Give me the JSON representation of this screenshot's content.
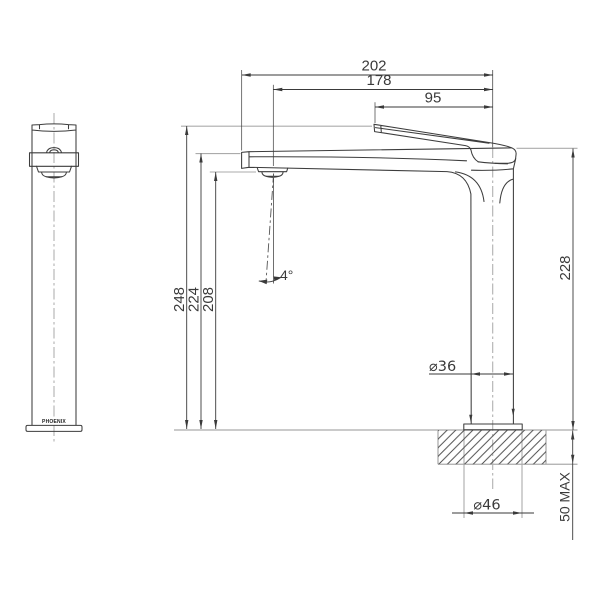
{
  "drawing": {
    "brand_label": "PHOENIX",
    "angle_label": "4°",
    "dimensions": {
      "spout_overall": "202",
      "outlet_to_center": "178",
      "lever_tip_to_center": "95",
      "overall_height": "248",
      "spout_height": "224",
      "outlet_height": "208",
      "body_height": "228",
      "body_diameter": "⌀36",
      "hole_diameter": "⌀46",
      "deck_max": "50 MAX"
    },
    "colors": {
      "outline": "#3d3d3d",
      "construction": "#ababab",
      "hatch": "#4d4d4d",
      "background": "#ffffff"
    }
  }
}
